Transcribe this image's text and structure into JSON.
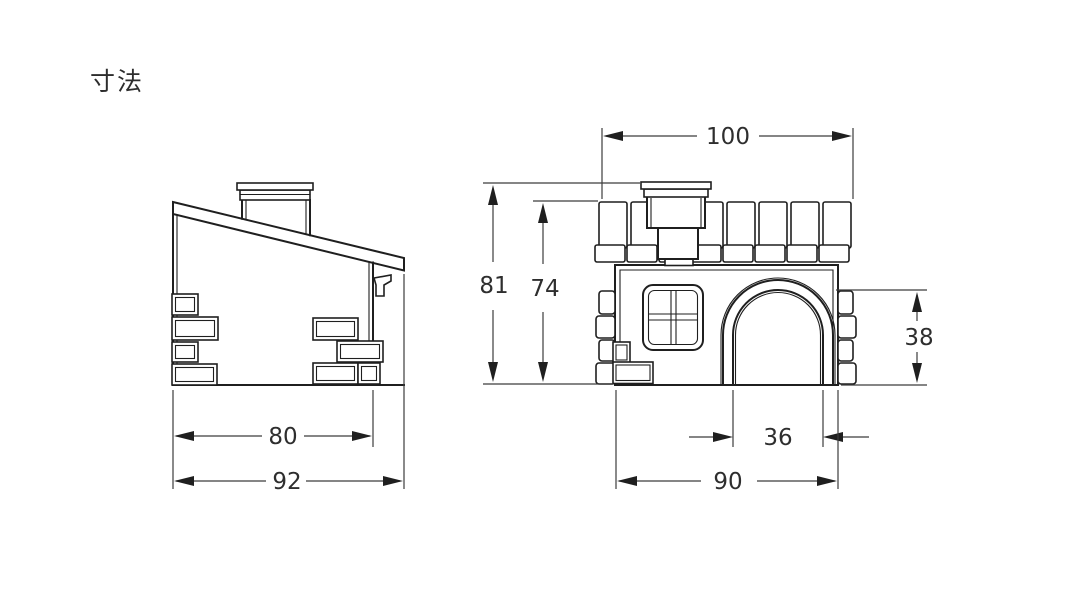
{
  "page": {
    "title": "寸法"
  },
  "drawing": {
    "background": "#ffffff",
    "line_color": "#1f1f1f",
    "dimension_color": "#3c3c3c"
  },
  "side_view": {
    "dimensions": {
      "body_depth": "80",
      "overall_depth": "92"
    }
  },
  "front_view": {
    "dimensions": {
      "roof_width": "100",
      "overall_height": "81",
      "body_height": "74",
      "door_height": "38",
      "door_width": "36",
      "body_width": "90"
    }
  }
}
